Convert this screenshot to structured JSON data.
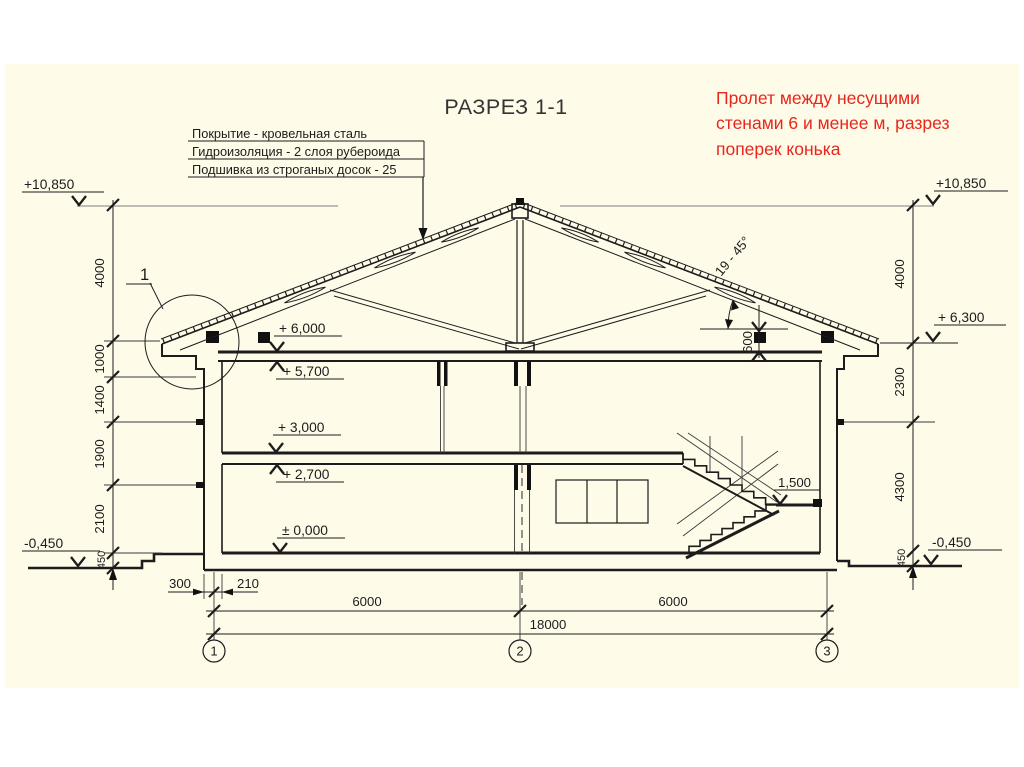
{
  "slide": {
    "title": "РАЗРЕЗ 1-1",
    "background": "#fffbe9"
  },
  "note": {
    "text": "Пролет между несущими стенами 6 и менее м, разрез поперек конька",
    "color": "#e8261c"
  },
  "roof_spec": {
    "line1": "Покрытие - кровельная сталь",
    "line2": "Гидроизоляция - 2 слоя рубероида",
    "line3": "Подшивка из строганых досок - 25"
  },
  "levels": {
    "left_top": "+10,850",
    "right_top": "+10,850",
    "right_eave": "+ 6,300",
    "attic_floor": "+ 6,000",
    "upper_ceiling": "+ 5,700",
    "second_floor": "+ 3,000",
    "first_ceiling": "+ 2,700",
    "ground_floor": "± 0,000",
    "grade_left": "-0,450",
    "grade_right": "-0,450",
    "stair_landing": "1,500"
  },
  "dims": {
    "left_chain": [
      "4000",
      "1000",
      "1400",
      "1900",
      "2100",
      "450"
    ],
    "right_chain": [
      "4000",
      "2300",
      "4300",
      "450"
    ],
    "wall_left": [
      "300",
      "210"
    ],
    "span_1": "6000",
    "span_2": "6000",
    "total": "18000",
    "mauerlat_height": "600",
    "roof_angle": "19 - 45°"
  },
  "axes": {
    "a1": "1",
    "a2": "2",
    "a3": "3"
  },
  "detail": {
    "marker": "1"
  }
}
